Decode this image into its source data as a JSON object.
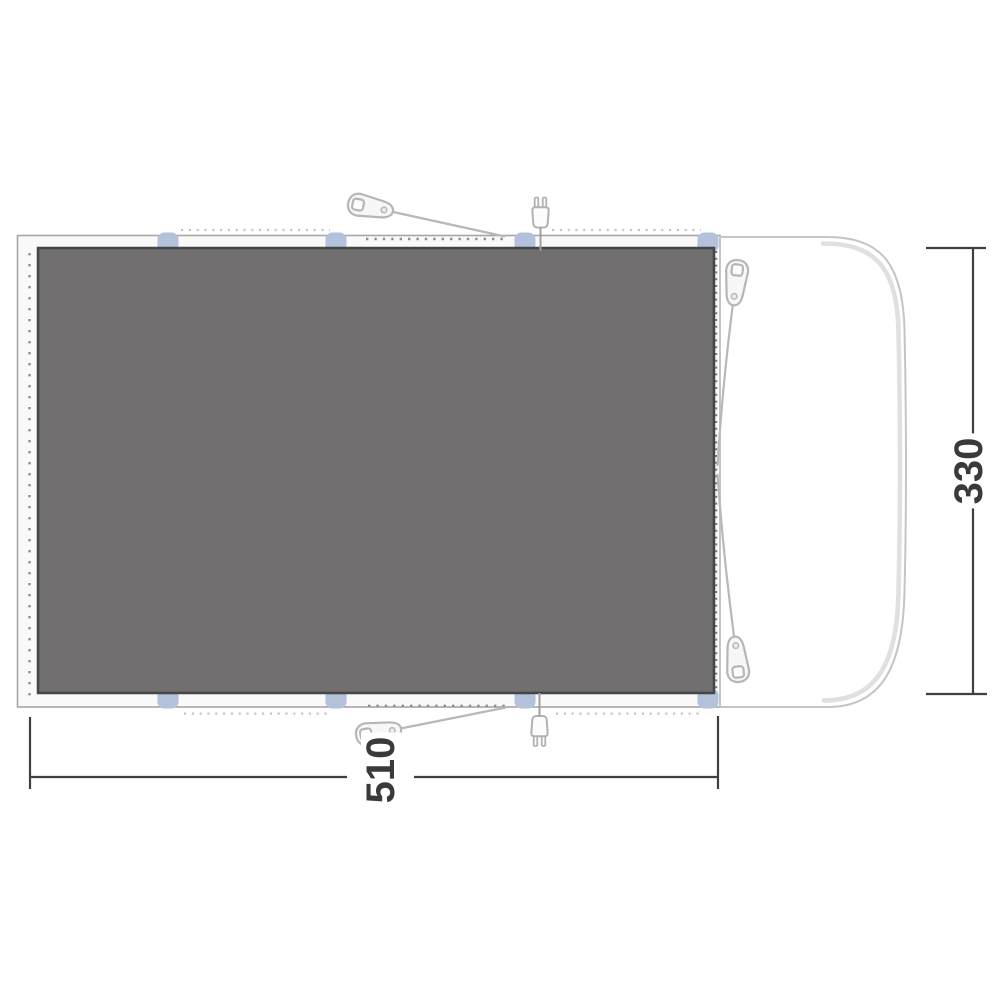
{
  "diagram": {
    "type": "groundsheet-floorplan-with-vehicle",
    "width_label": "510",
    "length_label": "330",
    "colors": {
      "groundsheet_fill": "#706e6f",
      "groundsheet_border": "#454545",
      "sheet_band_fill": "#f9f9f9",
      "sheet_band_border": "#a5a5a5",
      "tab_blue": "#b3c1da",
      "vehicle_outline": "#c4c4c4",
      "vehicle_inner_band": "#e0e0e0",
      "rope_gray": "#b8b8b8",
      "dimension_color": "#3f3f3f"
    },
    "icons": {
      "guyline_toggle_count": 4,
      "power_plug_count": 2,
      "attachment_tab_count": 8
    }
  }
}
